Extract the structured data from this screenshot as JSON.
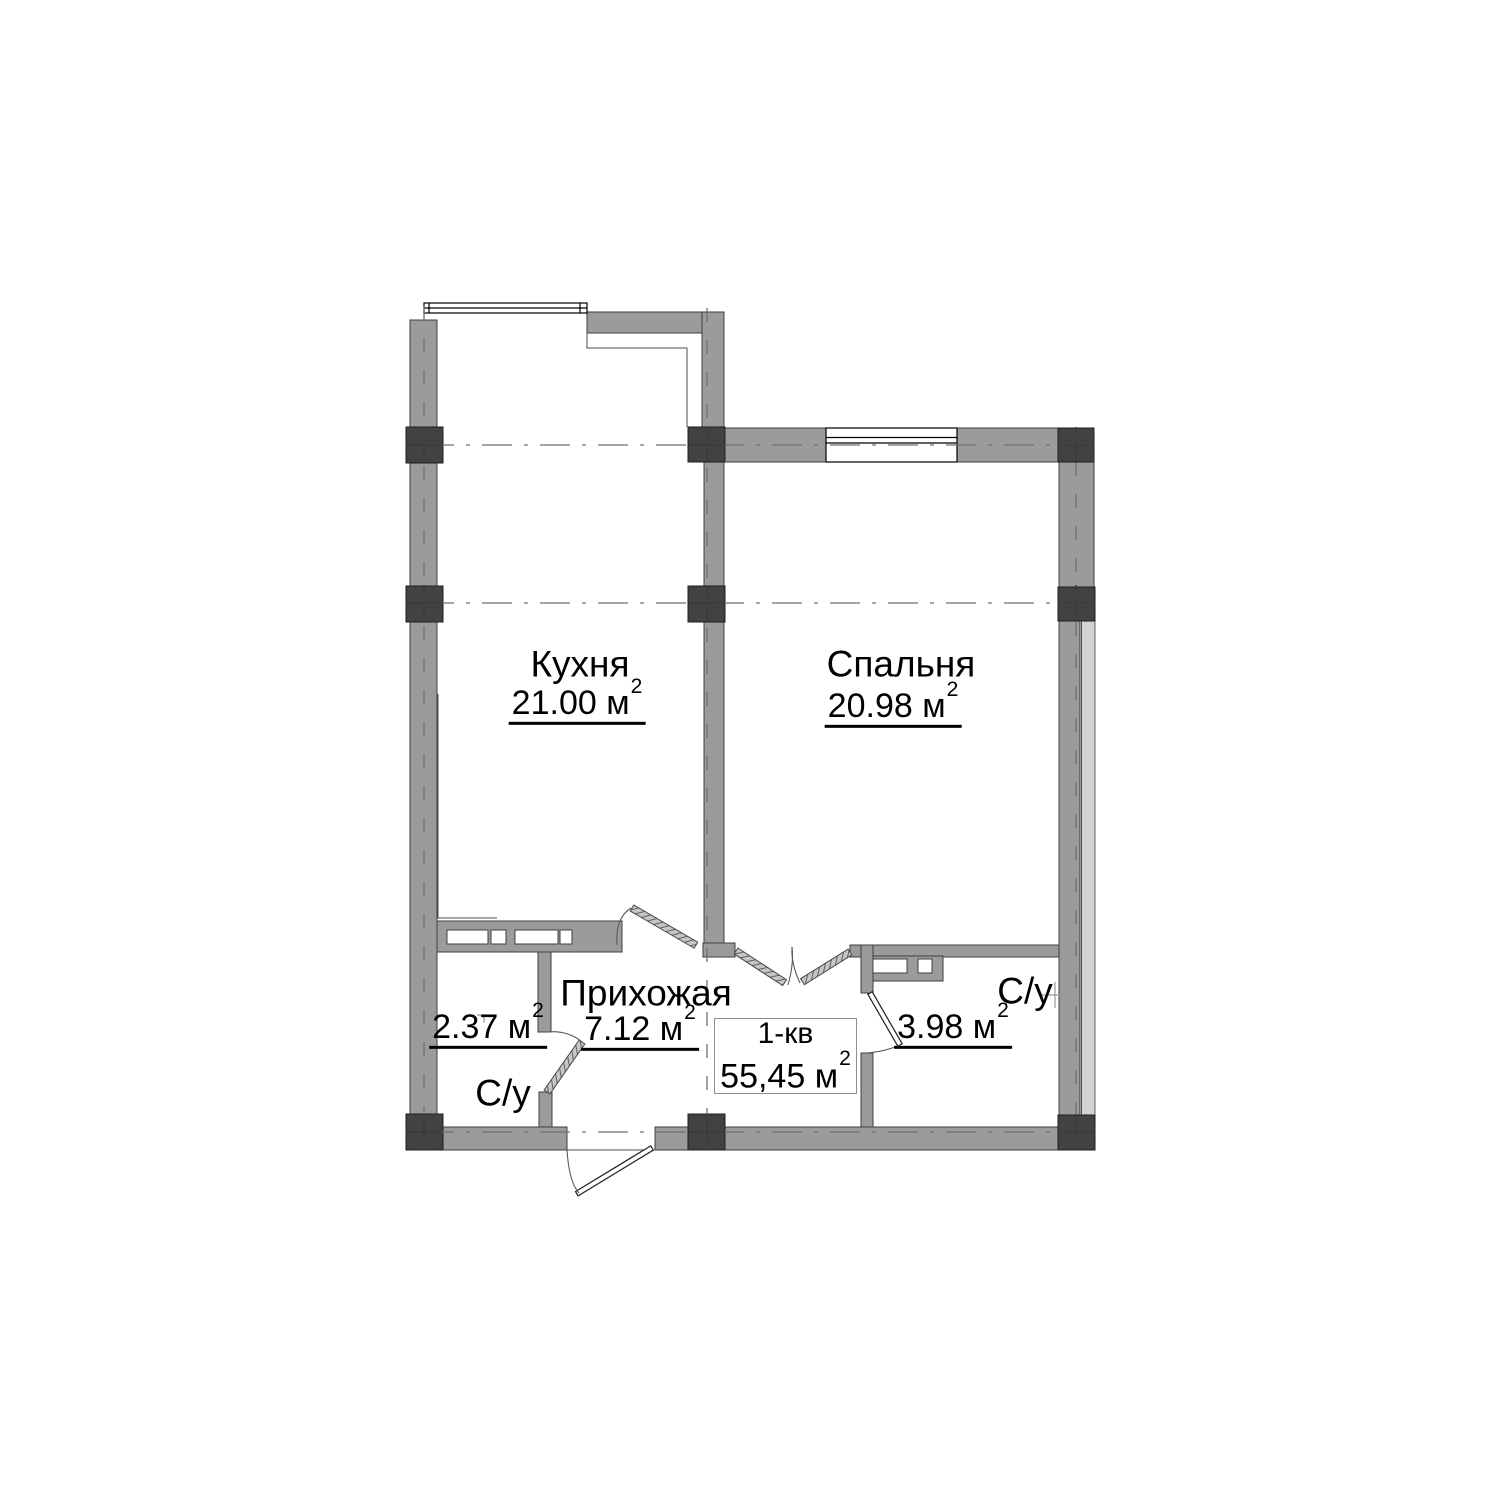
{
  "plan_labels": {
    "kitchen": {
      "name": "Кухня",
      "area": "21.00 м",
      "area_sup": "2"
    },
    "bedroom": {
      "name": "Спальня",
      "area": "20.98 м",
      "area_sup": "2"
    },
    "hallway": {
      "name": "Прихожая",
      "area": "7.12 м",
      "area_sup": "2"
    },
    "bath_left": {
      "name": "С/у",
      "area": "2.37 м",
      "area_sup": "2"
    },
    "bath_right": {
      "name": "С/у",
      "area": "3.98 м",
      "area_sup": "2"
    },
    "info_box": {
      "apartment": "1-кв",
      "total_area": "55,45 м",
      "area_sup": "2"
    }
  },
  "colors": {
    "wall-fill": "#9b9b9b",
    "wall-outline": "#3f3f3f",
    "column-fill": "#424242",
    "glazing-fill": "#d3d3d3",
    "axis-line": "#6f6f6f",
    "text-color": "#000000"
  }
}
